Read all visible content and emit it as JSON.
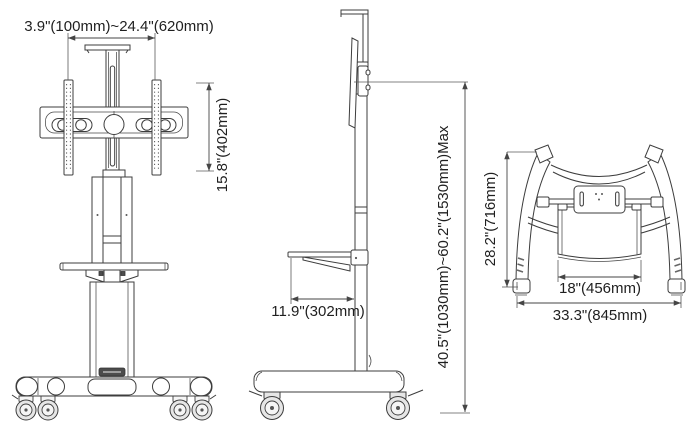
{
  "diagram": {
    "background": "#ffffff",
    "line_color": "#3d3d3d",
    "text_color": "#1f1f1f",
    "views": {
      "front": {
        "width_range_label": "3.9\"(100mm)~24.4\"(620mm)",
        "bracket_height_label": "15.8\"(402mm)"
      },
      "side": {
        "shelf_depth_label": "11.9\"(302mm)",
        "height_range_label": "40.5\"(1030mm)~60.2\"(1530mm)Max"
      },
      "rear": {
        "depth_label": "28.2\"(716mm)",
        "shelf_width_label": "18\"(456mm)",
        "base_width_label": "33.3\"(845mm)"
      }
    }
  }
}
